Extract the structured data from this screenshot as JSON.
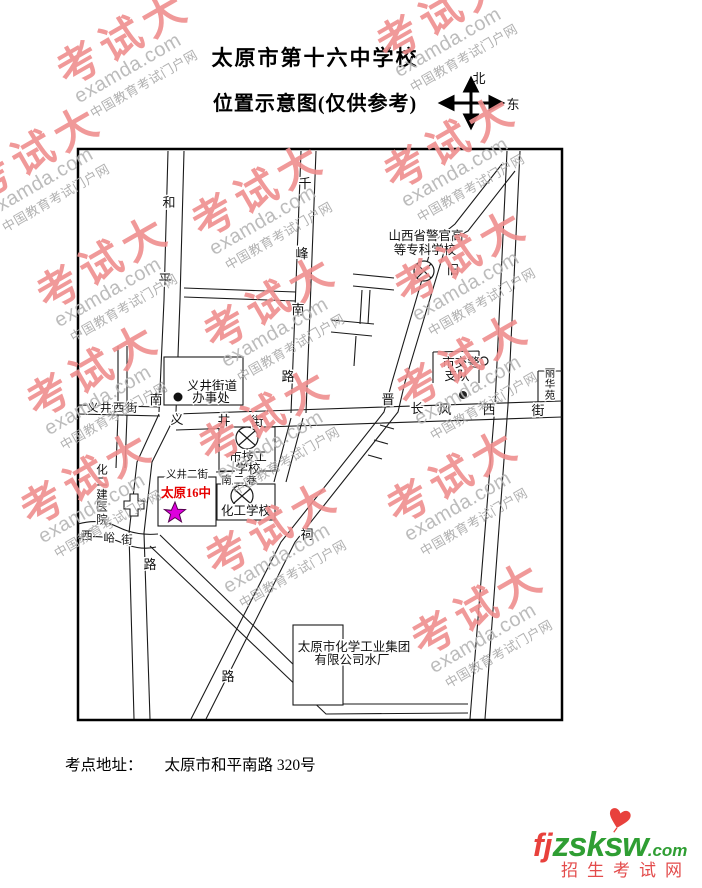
{
  "title": {
    "line1": "太原市第十六中学校",
    "line2": "位置示意图(仅供参考)"
  },
  "compass": {
    "north": "北",
    "east": "东"
  },
  "watermark": {
    "brand": "考试大",
    "domain": "examda.com",
    "tagline": "中国教育考试门户网"
  },
  "map": {
    "roads": {
      "heping_south_road": [
        "和",
        "平",
        "南",
        "路"
      ],
      "qianfeng_south_road": [
        "千",
        "峰",
        "南",
        "路"
      ],
      "yijing_west_street": "义井西街",
      "yijing_street": [
        "义",
        "井",
        "街"
      ],
      "changfeng_west_street": [
        "长",
        "风",
        "西",
        "街"
      ],
      "jinci_road": [
        "晋",
        "祠",
        "路"
      ],
      "xiyu_street": [
        "西",
        "峪",
        "街"
      ],
      "yijing_2nd_street": "义井二街",
      "nan_er_lane": "南二巷",
      "old_road_mark": "旧"
    },
    "places": {
      "police_college_line1": "山西省警官高",
      "police_college_line2": "等专科学校",
      "street_office_line1": "义井街道",
      "street_office_line2": "办事处",
      "traffic_police_line1": "市交警",
      "traffic_police_line2": "支队",
      "lihua_yuan": [
        "丽",
        "华",
        "苑"
      ],
      "tech_school_line1": "市技工",
      "tech_school_line2": "学校",
      "chem_school": "化工学校",
      "exam_school": "太原16中",
      "hospital": [
        "化",
        "二",
        "建",
        "医",
        "院"
      ],
      "water_plant_line1": "太原市化学工业集团",
      "water_plant_line2": "有限公司水厂"
    }
  },
  "footer": {
    "label": "考点地址：",
    "address": "太原市和平南路 320号"
  },
  "logo": {
    "prefix": "fj",
    "name": "zsksw",
    "suffix": ".com",
    "subtitle": "招生考试网"
  },
  "colors": {
    "exam_school_text": "#e60000",
    "star": "#dd00dd",
    "watermark_brand": "#ef8e8e",
    "logo_red": "#e8413c",
    "logo_green": "#2f9e33"
  }
}
